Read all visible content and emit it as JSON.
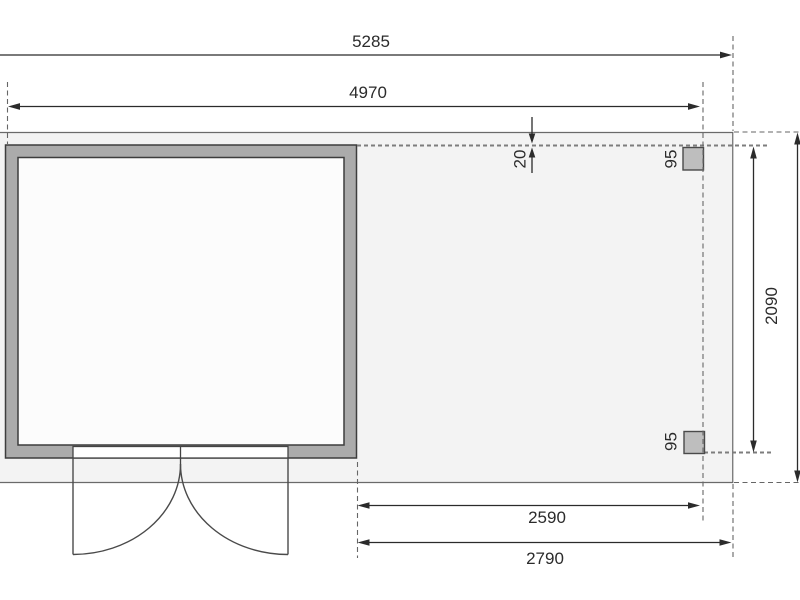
{
  "drawing": {
    "type": "garden-house-floor-plan",
    "dimensions": {
      "overall_width": "5285",
      "house_width": "4970",
      "roof_edge_offset": "20",
      "post_size_top": "95",
      "post_size_bottom": "95",
      "annex_depth": "2090",
      "annex_width_inner": "2590",
      "annex_width_outer": "2790"
    },
    "colors": {
      "background": "#ffffff",
      "footprint_fill": "#f3f3f3",
      "wall_fill": "#ababab",
      "interior_fill": "#fcfcfc",
      "door_panel_fill": "#ffffff",
      "post_fill": "#bebebe",
      "dimension_line": "#2b2b2b",
      "dashed_line": "#777777"
    }
  }
}
